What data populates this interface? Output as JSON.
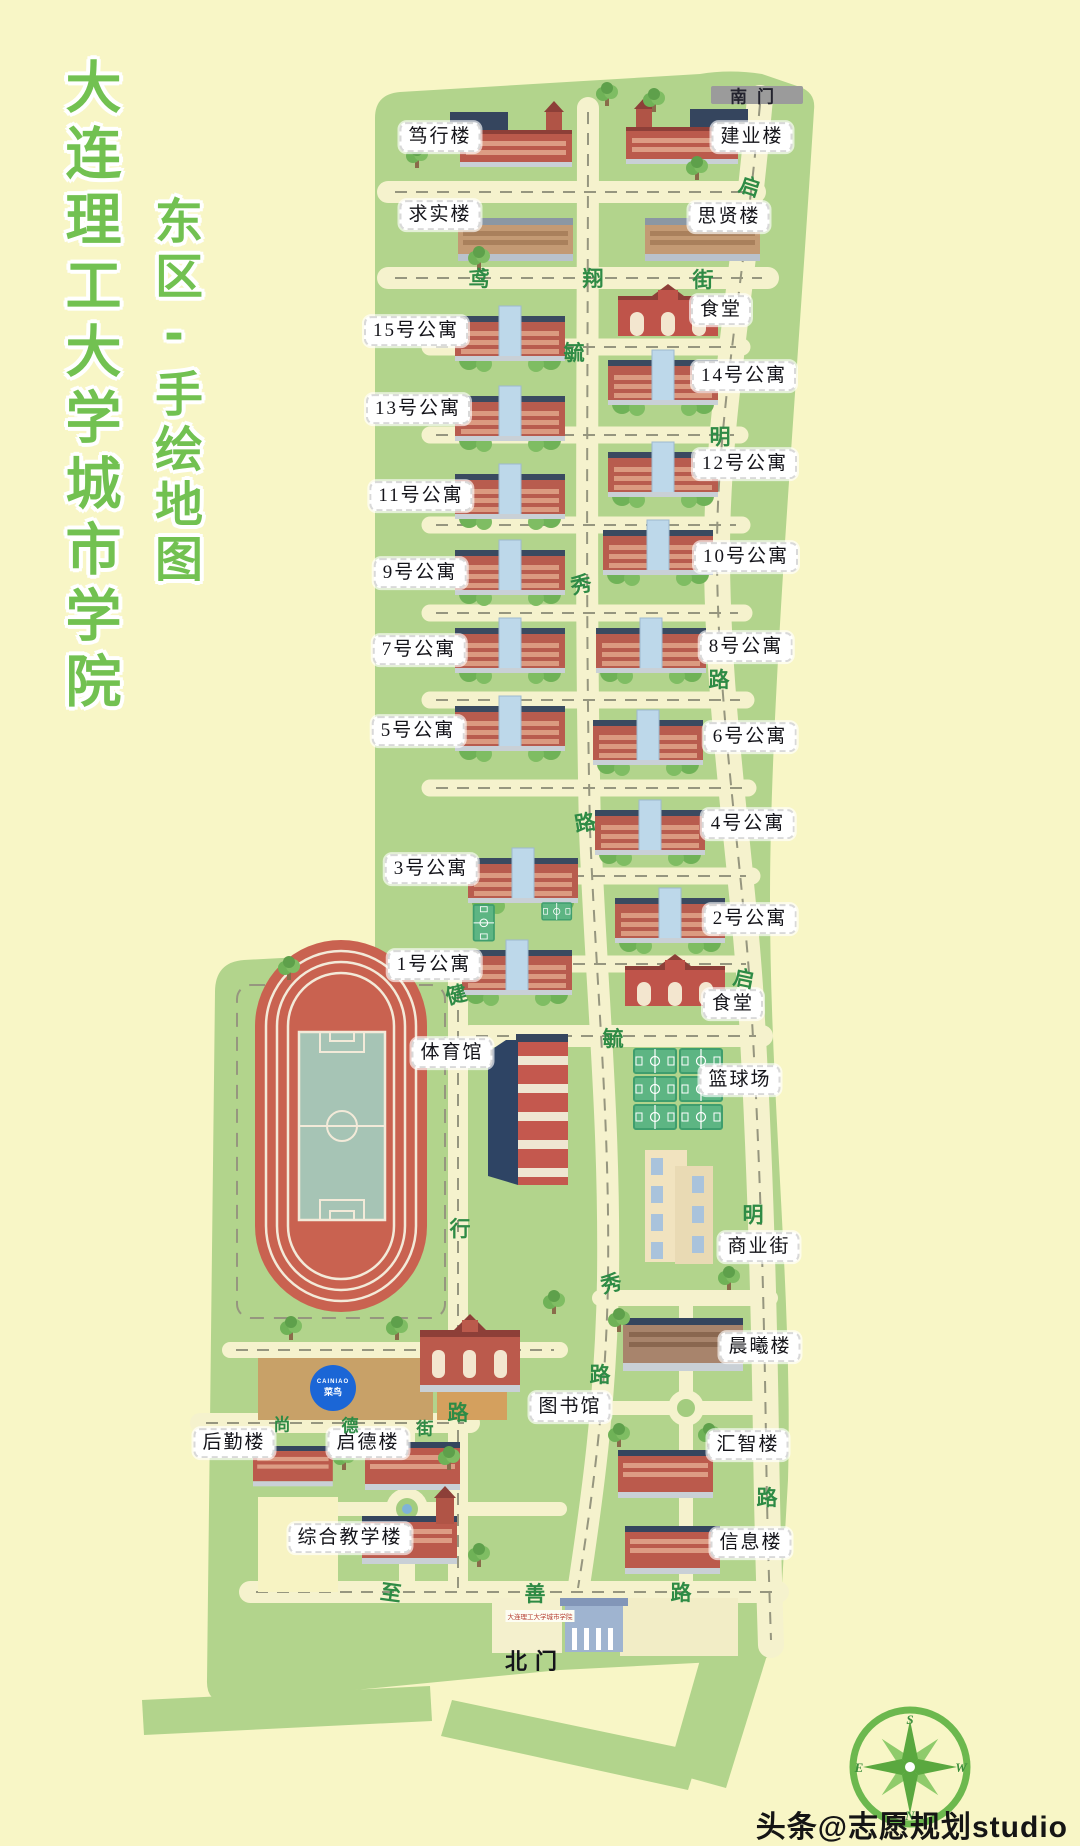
{
  "title": {
    "line1": "大连理工大学城市学院",
    "line2": "东区-手绘地图"
  },
  "watermark": "头条@志愿规划studio",
  "gates": {
    "south": "南门",
    "north": "北门",
    "north_sign": "大连理工大学城市学院"
  },
  "kiosk": {
    "latin": "CAINIAO",
    "name": "菜鸟"
  },
  "compass": {
    "n": "N",
    "s": "S",
    "e": "E",
    "w": "W"
  },
  "buildings": {
    "duxing": "笃行楼",
    "jianye": "建业楼",
    "qiushi": "求实楼",
    "sixian": "思贤楼",
    "canteen_north": "食堂",
    "canteen_south": "食堂",
    "apt15": "15号公寓",
    "apt14": "14号公寓",
    "apt13": "13号公寓",
    "apt12": "12号公寓",
    "apt11": "11号公寓",
    "apt10": "10号公寓",
    "apt9": "9号公寓",
    "apt8": "8号公寓",
    "apt7": "7号公寓",
    "apt6": "6号公寓",
    "apt5": "5号公寓",
    "apt4": "4号公寓",
    "apt3": "3号公寓",
    "apt2": "2号公寓",
    "apt1": "1号公寓",
    "basketball": "篮球场",
    "gym": "体育馆",
    "mall": "商业街",
    "chenxi": "晨曦楼",
    "library": "图书馆",
    "huizhi": "汇智楼",
    "houqin": "后勤楼",
    "qide": "启德楼",
    "zonghe": "综合教学楼",
    "xinxi": "信息楼"
  },
  "streets": {
    "yuanxiang": {
      "name": "鸢翔街",
      "chars": [
        "鸢",
        "翔",
        "街"
      ]
    },
    "qiming": {
      "name": "启明路",
      "chars": [
        "启",
        "明",
        "路"
      ]
    },
    "yuxiu": {
      "name": "毓秀路",
      "chars": [
        "毓",
        "秀",
        "路"
      ]
    },
    "jianxing": {
      "name": "健行路",
      "chars": [
        "健",
        "行",
        "路"
      ]
    },
    "shangde": {
      "name": "尚德街",
      "chars": [
        "尚",
        "德",
        "街"
      ]
    },
    "zhishan": {
      "name": "至善路",
      "chars": [
        "至",
        "善",
        "路"
      ]
    }
  },
  "colors": {
    "background": "#f8f6c6",
    "campus_green": "#b2d48c",
    "road_cream": "#f5f2cd",
    "title_green": "#72c151",
    "street_char_green": "#2e8b45",
    "track_red": "#c96250",
    "field_teal": "#a6c4b5",
    "court_green": "#5db583",
    "building_red": "#bb5a4c",
    "roof_navy": "#35455e",
    "tower_blue": "#bdd8ea",
    "gate_gray": "#9b9b9b",
    "cainiao_blue": "#1b66d6"
  }
}
